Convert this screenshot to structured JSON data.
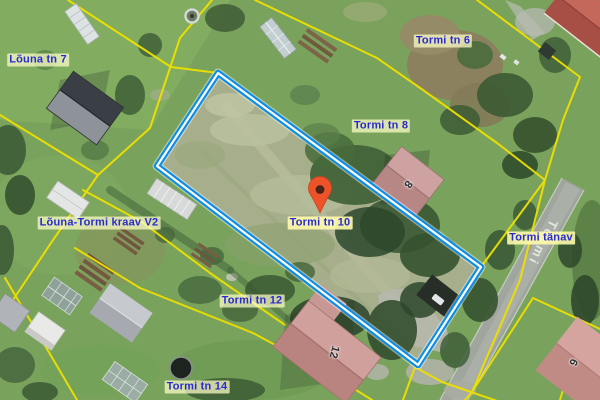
{
  "labels": {
    "louna_tn_7": "Lõuna tn 7",
    "tormi_tn_6": "Tormi tn 6",
    "tormi_tn_8": "Tormi tn 8",
    "tormi_tn_10": "Tormi tn 10",
    "louna_tormi_kraav": "Lõuna-Tormi kraav V2",
    "tormi_tanav": "Tormi tänav",
    "tormi_tn_12": "Tormi tn 12",
    "tormi_tn_14": "Tormi tn 14"
  },
  "road_name": "Tormi",
  "building_numbers": {
    "b8": "8",
    "b12": "12",
    "b6": "6"
  },
  "marker": {
    "type": "location-pin",
    "parcel": "Tormi tn 10"
  },
  "colors": {
    "parcel_line_yellow": "#f0e000",
    "selected_parcel_blue": "#0d8ee6",
    "label_text_blue": "#2a2ace",
    "label_background": "#ffffc8",
    "pin_fill": "#ee5228",
    "road_surface": "#a0a59e"
  }
}
